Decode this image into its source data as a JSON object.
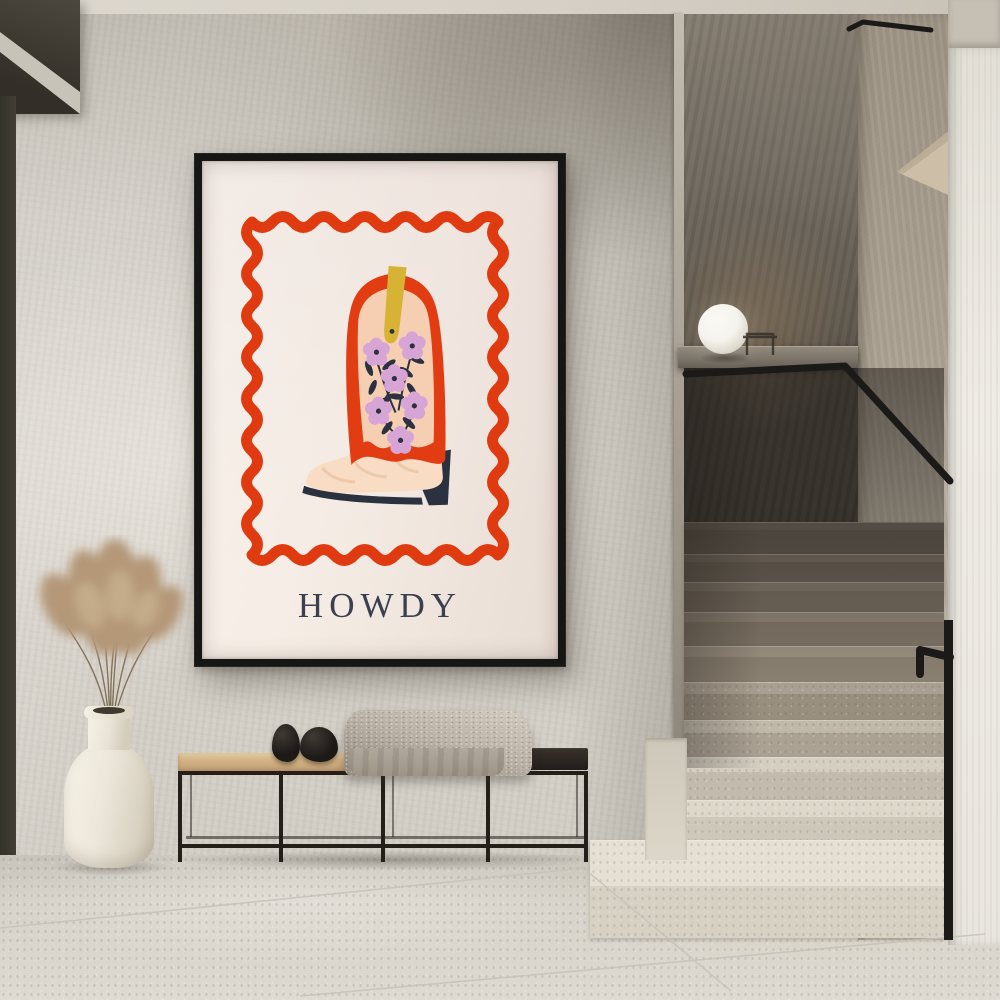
{
  "poster": {
    "title": "HOWDY",
    "subject": "floral cowboy boot framed by a wavy hand-drawn border",
    "colors": {
      "frame": "#161614",
      "paper": "#f3ebe3",
      "wavy_border": "#e03a10",
      "boot_red": "#e23c12",
      "panel_peach": "#f6cfb2",
      "flower_lilac": "#d7a5d5",
      "accents_navy": "#2c3140",
      "pull_tab_yellow": "#d6b334",
      "foot_cream": "#f8dcc3",
      "title_color": "#3a4050"
    }
  },
  "room": {
    "palette": {
      "ceiling": "#d9d4ca",
      "wall": "#d3cfc7",
      "door_dark": "#423e35",
      "stair_wall_dark": "#6b6459",
      "stair_wall_beige": "#b2a99b",
      "white_wall": "#ebe8e1",
      "handrail": "#1b1a18",
      "lamp": "#f5f3ed",
      "ledge": "#7e766b",
      "step_light": "#e2ddd0",
      "step_dark": "#6e655a",
      "floor": "#d4d0c8",
      "floor_seam": "#c6c2b9",
      "bench_frame": "#242019",
      "bench_cushion": "#d2b084",
      "bench_top": "#2c2622",
      "blanket": "#b8b0a4",
      "stone": "#1c1917",
      "vase": "#ece6da",
      "pampas": "#b49878"
    }
  }
}
